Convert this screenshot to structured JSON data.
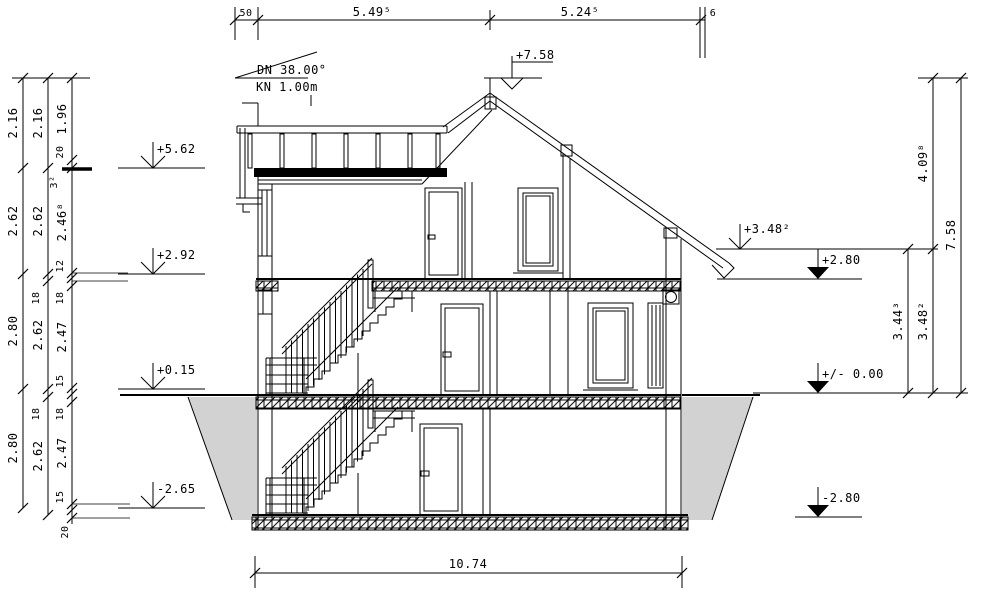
{
  "title": "building-cross-section",
  "colors": {
    "line": "#000000",
    "ground_fill": "#d2d2d2",
    "slab_fill": "#e7e2e7",
    "slab_hatch": "#8c5578"
  },
  "roof_note": {
    "line1": "DN 38.00°",
    "line2": "KN 1.00m"
  },
  "levels": {
    "ridge": "+7.58",
    "terrace": "+5.62",
    "og_floor": "+2.92",
    "eg_floor": "+0.15",
    "kg_floor": "-2.65",
    "eave": "+3.48²",
    "og_slab": "+2.80",
    "zero": "+/- 0.00",
    "kg_slab": "-2.80"
  },
  "dims": {
    "top": [
      "50",
      "5.49⁵",
      "5.24⁵",
      "6"
    ],
    "bottom": "10.74",
    "left_chain_outer": [
      "2.16",
      "2.62",
      "2.80",
      "2.80"
    ],
    "left_chain_middle": [
      "2.16",
      "2.62",
      "18",
      "2.62",
      "18",
      "2.62"
    ],
    "left_chain_inner": [
      "1.96",
      "20",
      "3²",
      "2.46⁸",
      "12",
      "18",
      "2.47",
      "15",
      "18",
      "2.47",
      "15",
      "20"
    ],
    "right_chain_inner": [
      "3.44³"
    ],
    "right_chain_middle": [
      "4.09⁸",
      "3.48²"
    ],
    "right_chain_outer": [
      "7.58"
    ]
  }
}
